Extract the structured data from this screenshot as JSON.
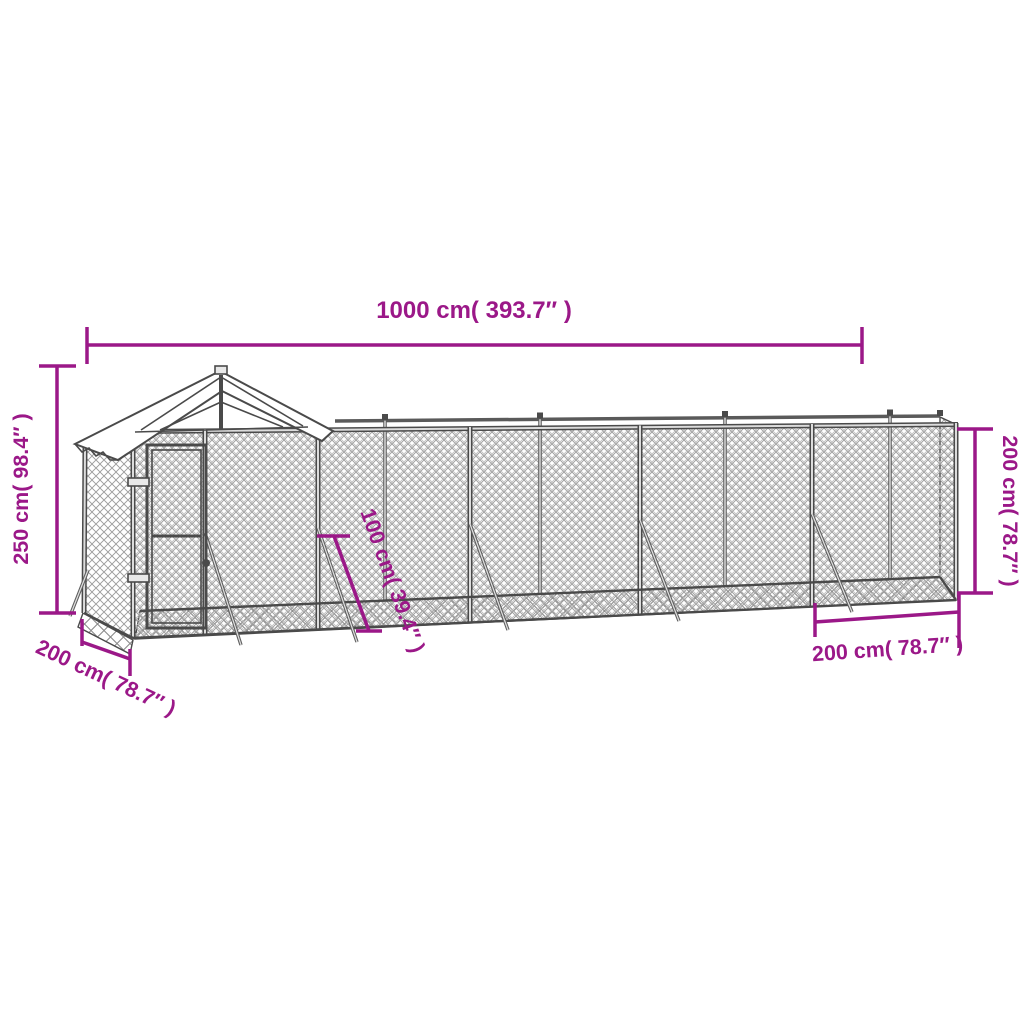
{
  "diagram": {
    "kind": "product-dimension-diagram",
    "subject": "outdoor dog kennel run with gabled roof section, chain-link mesh, silver",
    "accent_color": "#9B1888",
    "structure_color": "#4a4a4a",
    "background_color": "#ffffff",
    "labels": {
      "width_top": "1000 cm( 393.7″ )",
      "height_left": "250 cm( 98.4″ )",
      "height_right": "200 cm( 78.7″ )",
      "depth_bottom_left": "200 cm( 78.7″ )",
      "depth_bottom_right": "200 cm( 78.7″ )",
      "stake_length_middle": "100 cm( 39.4″ )"
    }
  }
}
